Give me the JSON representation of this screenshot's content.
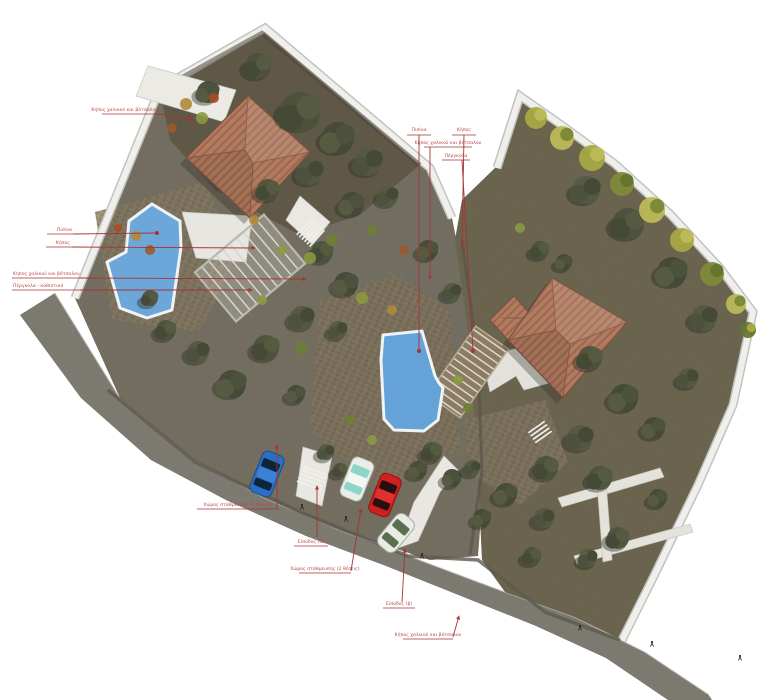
{
  "title": "Κάτοψη διαμόρφωσης οικοπέδου (site plan rendering)",
  "colors": {
    "background": "#ffffff",
    "annotation_red": "#a93232",
    "annotation_text_red": "#b84848",
    "pool_blue": "#64a2d8",
    "pool_coping_white": "#f0f3f4",
    "roof_terracotta": "#b27a5e",
    "roof_line": "#8a5a46",
    "road_gray": "#9e9e9c",
    "curb_white": "#f4f4f1",
    "earth_brown": "#675d4b",
    "gravel_gray": "#8d8779",
    "cobble_tan": "#9c8a72",
    "foliage_olive": "#4d523c",
    "bush_yellow_green": "#a8a844",
    "path_white": "#e8e7e1"
  },
  "features": {
    "houses": 2,
    "pools": 2,
    "pergolas": 2,
    "entrances": 2,
    "parking_areas": 2
  },
  "cars": [
    {
      "name": "blue-car",
      "color": "#2b6fc4"
    },
    {
      "name": "white-car",
      "color": "#eaeee9"
    },
    {
      "name": "red-car",
      "color": "#cf1f1f"
    },
    {
      "name": "white-suv",
      "color": "#e9ebe4"
    }
  ],
  "annotations": [
    {
      "id": "garden-gravel-pebble-1",
      "label": "Κήπος χαλικού και βότσαλου"
    },
    {
      "id": "pool-left",
      "label": "Πισίνα"
    },
    {
      "id": "garden-left",
      "label": "Κήπος"
    },
    {
      "id": "garden-gravel-pebble-2",
      "label": "Κήπος χαλικού και βότσαλου"
    },
    {
      "id": "pergola-seating",
      "label": "Πέργκολα - καθιστικό"
    },
    {
      "id": "pool-right",
      "label": "Πισίνα"
    },
    {
      "id": "garden-right",
      "label": "Κήπος"
    },
    {
      "id": "garden-gravel-pebble-3",
      "label": "Κήπος χαλικού και βότσαλου"
    },
    {
      "id": "pergola-right",
      "label": "Πέργκολα"
    },
    {
      "id": "parking-area-1",
      "label": "Χώρος στάθμευσης  (2 θέσεις)"
    },
    {
      "id": "entrance-a",
      "label": "Είσοδος (α)"
    },
    {
      "id": "parking-area-2",
      "label": "Χώρος στάθμευσης  (2 θέσεις)"
    },
    {
      "id": "entrance-b",
      "label": "Είσοδος (β)"
    },
    {
      "id": "garden-gravel-pebble-4",
      "label": "Κήπος χαλικού και βότσαλου"
    }
  ]
}
